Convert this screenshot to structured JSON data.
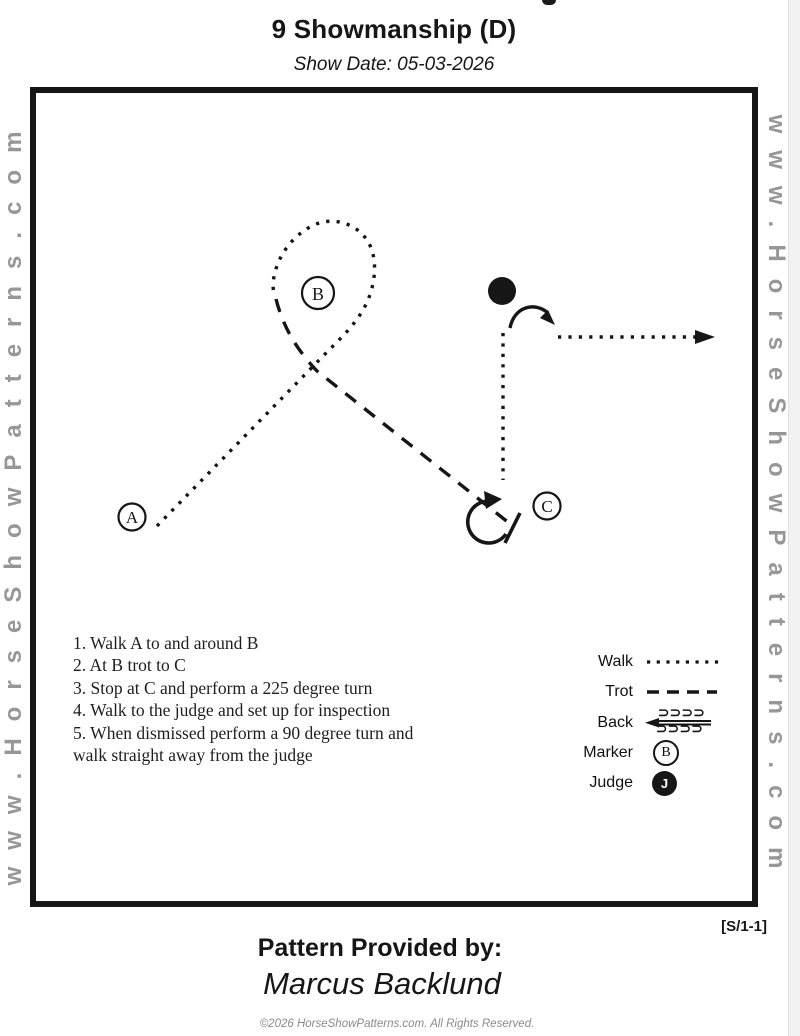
{
  "page": {
    "title": "9 Showmanship (D)",
    "show_date": "Show Date: 05-03-2026",
    "watermark_left": "www.HorseShowPatterns.com",
    "watermark_right": "www.HorseShowPatterns.com",
    "pattern_code": "[S/1-1]",
    "provided_by_label": "Pattern Provided by:",
    "provided_by_name": "Marcus Backlund",
    "footer": "©2026 HorseShowPatterns.com. All Rights Reserved."
  },
  "diagram": {
    "markers": {
      "a": "A",
      "b": "B",
      "c": "C",
      "judge": "J"
    }
  },
  "instructions": [
    "1. Walk A to and around B",
    "2. At B trot to C",
    "3. Stop at C and perform a 225 degree turn",
    "4. Walk to the judge and set up for inspection",
    "5. When dismissed perform a 90 degree turn and",
    "walk straight away from the judge"
  ],
  "legend": {
    "walk_label": "Walk",
    "trot_label": "Trot",
    "back_label": "Back",
    "marker_label": "Marker",
    "judge_label": "Judge",
    "marker_symbol": "B",
    "judge_symbol": "J",
    "back_symbol": "⊃⊃⊃⊃"
  },
  "colors": {
    "ink": "#161616",
    "watermark_gray": "#979797",
    "footer_gray": "#8a8a8a"
  }
}
